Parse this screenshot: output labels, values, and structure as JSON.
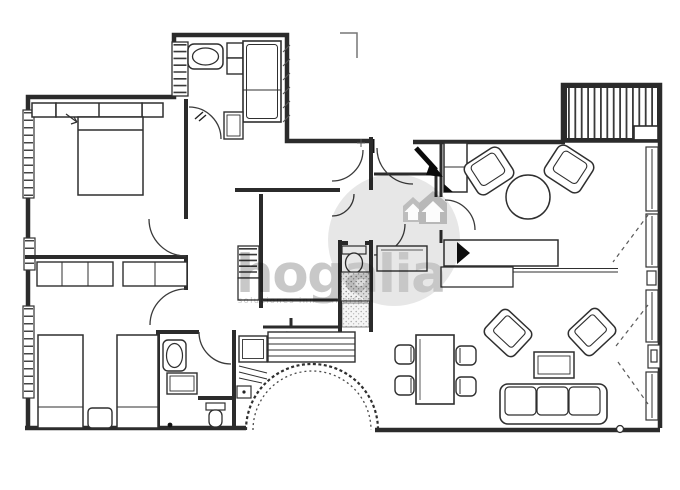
{
  "watermark": {
    "brand": "hogalia",
    "tagline": "soluciones inmobiliarias",
    "circle_color": "#d9d9d9",
    "brand_text_color": "#c3c3c3",
    "tagline_text_color": "#cccccc",
    "logo_icon": "hogalia-house-arrows-icon"
  },
  "plan": {
    "background_color": "#ffffff",
    "ink_color": "#2b2b2b",
    "type": "apartment-floor-plan-scan",
    "rooms": [
      "bedroom-double-top-left",
      "bathroom-top",
      "entry-hall",
      "closet-corridor",
      "wc-shower-room-center",
      "bedroom-twin-bottom-left",
      "bathroom-bottom",
      "toilet-nook",
      "laundry-niche",
      "dining-area",
      "living-room",
      "terrace-deck-top-right"
    ],
    "furniture": [
      "double-bed",
      "nightstand-left",
      "nightstand-right",
      "wardrobe-row",
      "twin-bed-1",
      "twin-bed-2",
      "shared-nightstand",
      "towel-radiator",
      "washbasin-top",
      "toilet-cabinet",
      "bathtub",
      "bidet-cabinet",
      "shelf-unit",
      "storage-cabinet",
      "toilet-center",
      "shower-tray-speckled",
      "washbasin-bottom",
      "shower-tray",
      "toilet-bottom",
      "washing-machine",
      "dining-table",
      "dining-chair-1",
      "dining-chair-2",
      "dining-chair-3",
      "dining-chair-4",
      "armchair-1",
      "armchair-2",
      "round-side-table",
      "tall-cabinet",
      "sideboard",
      "tv-wedge",
      "console-table",
      "side-cabinet",
      "armchair-3",
      "armchair-4",
      "coffee-table",
      "three-seat-sofa"
    ],
    "features": [
      "entrance-door-black-leaf",
      "interior-door-swings",
      "arched-opening-with-steps",
      "window-bands-left-wall",
      "window-bands-right-wall",
      "deck-hatching",
      "curtain-swing-dashes",
      "step-lines"
    ]
  }
}
